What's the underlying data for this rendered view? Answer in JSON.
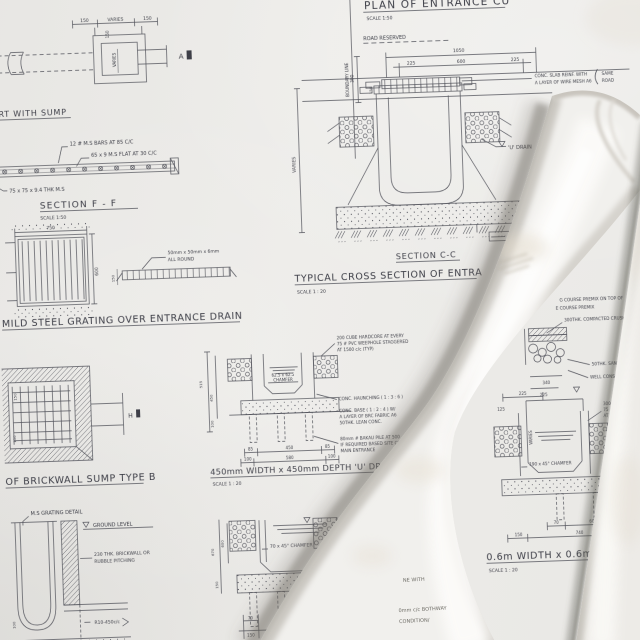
{
  "colors": {
    "sheet": "#eae9e6",
    "ink": "#50525c",
    "roll_paper": "#f1f0ed",
    "shadow": "#8f8c85"
  },
  "labels": {
    "culvert": {
      "dim_left": "150",
      "dim_mid": "VARIES",
      "dim_right": "150",
      "dim_v": "150",
      "dim_inner": "VARIES",
      "marker": "A",
      "title": "ERT WITH SUMP"
    },
    "section_ff": {
      "note_bars": "12 # M.S BARS AT 85 C/C",
      "note_flat": "65 x 9 M.S FLAT AT 30 C/C",
      "note_angle": "75 x 75 x 9.4 THK M.S",
      "title": "SECTION F - F",
      "scale": "SCALE 1:50"
    },
    "grating": {
      "dim_top": "750",
      "dim_right": "600",
      "dim_side": "150",
      "note_l1": "50mm x 50mm x 6mm",
      "note_l2": "ALL ROUND",
      "caption": "MILD STEEL GRATING OVER ENTRANCE DRAIN"
    },
    "entrance_plan": {
      "title": "PLAN OF ENTRANCE CU",
      "scale": "SCALE 1:50",
      "boundary": "BOUNDARY LINE",
      "road": "ROAD RESERVED",
      "dim_1050": "1050",
      "dim_225a": "225",
      "dim_600": "600",
      "dim_225b": "225",
      "dim_300": "300",
      "dim_150": "150",
      "note_l1": "CONC. SLAB REINF. WITH",
      "note_l2": "A LAYER OF WIRE MESH A6",
      "note_r1": "SAME",
      "note_r2": "ROAD"
    },
    "section_cc": {
      "dim_varies": "VARIES",
      "u_drain": "'U' DRAIN",
      "title": "SECTION C-C",
      "cross_title": "TYPICAL CROSS SECTION OF ENTRA",
      "cross_scale": "SCALE 1 : 20"
    },
    "drain450": {
      "dim_515": "515",
      "dim_450v": "450",
      "dim_100v": "100",
      "chamfer_l1": "62.5 x 62.5",
      "chamfer_l2": "CHAMFER",
      "dims_row1": [
        "85",
        "450",
        "85"
      ],
      "dims_row2": [
        "100",
        "580",
        "100"
      ],
      "note_hardcore": [
        "200 CUBE HARDCORE AT EVERY",
        "75 # PVC WEEPHOLE STAGGERED",
        "AT 1500 c/c (TYP)"
      ],
      "note_haunch": "CONC. HAUNCHING ( 1 : 3 : 6 )",
      "note_base": [
        "CONC. BASE ( 1 : 2 : 4 ) W/",
        "A LAYER OF BRC FABRIC A6",
        "50THK. LEAN CONC."
      ],
      "note_pile": [
        "80mm # BAKAU PILE AT 500",
        "IF REQUIRED BASED SITE CON",
        "MAIN ENTRANCE"
      ],
      "caption": "450mm WIDTH x 450mm DEPTH 'U' DRAIN",
      "scale": "SCALE 1 : 20"
    },
    "sump": {
      "caption": "OF BRICKWALL SUMP TYPE B",
      "marker": "H",
      "dim_a": "150",
      "dim_b": "150"
    },
    "grating_detail": {
      "label": "M.S GRATING DETAIL",
      "ground": "GROUND LEVEL",
      "wall_l1": "230 THK. BRICKWALL OR",
      "wall_l2": "RUBBLE PITCHING",
      "rebar": "R10-450c/c",
      "dim_v": "100"
    },
    "drain70": {
      "dim_670": "670",
      "dim_600": "600",
      "dim_150v": "150",
      "chamfer": "70 x 45° CHAMFER",
      "dim_70": "70",
      "dim_150": "150"
    },
    "pavement": {
      "n1": "G COURSE PREMIX ON TOP OF",
      "n2": "E COURSE PREMIX",
      "n3": "300THK. COMPACTED CRUSHER RUN",
      "n4": "50THK. SAND COURSE",
      "n5": "WELL CONSOLIDATED SUB",
      "dim_340": "340",
      "dim_225": "225"
    },
    "drain600": {
      "dim_225": "225",
      "dim_125": "125",
      "dim_varies": "VARIES",
      "chamfer": "190 x 45° CHAMFER",
      "note": [
        "300 CUBE HA",
        "75 # PVC W",
        "AT 1500 c"
      ],
      "dim_70": "70",
      "dim_600": "600",
      "dim_150a": "150",
      "dim_740": "740",
      "caption": "0.6m WIDTH x 0.6m DE",
      "scale": "SCALE 1 : 20"
    },
    "roll_fragments": {
      "f1": "NE WITH",
      "f2": "0mm c/c BOTHWAY",
      "f3": "CONDITION/"
    }
  }
}
